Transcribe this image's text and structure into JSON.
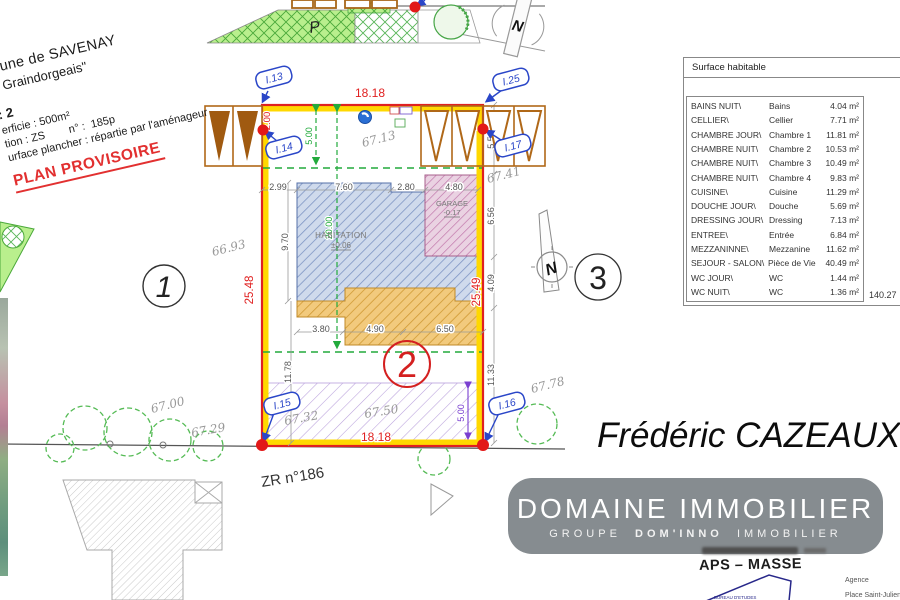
{
  "site_header": {
    "line1": "mune de SAVENAY",
    "line2": "a Graindorgeais\"",
    "line3": ": 2",
    "line4": "erficie : 500m²",
    "line5": "tion : ZS        n° :  185p",
    "line6": "urface plancher : répartie par l'aménageur",
    "stamp": "PLAN PROVISOIRE"
  },
  "plan": {
    "parcel_ref": "ZR n°186",
    "parking_label": "P",
    "north_label": "N",
    "lot_numbers": {
      "left": "1",
      "current": "2",
      "right": "3"
    },
    "point_labels": {
      "p13": "I.13",
      "p25": "I.25",
      "p14": "I.14",
      "p17": "I.17",
      "p15": "I.15",
      "p16": "I.16"
    },
    "buildings": {
      "habitation": "HABITATION",
      "habitation_level": "±0.06",
      "garage": "GARAGE",
      "garage_level": "-0.17"
    },
    "dims_red": {
      "width_top": "18.18",
      "width_bottom": "18.18",
      "depth_left": "25.48",
      "depth_right": "25.49",
      "corner_left": "2.00",
      "corner_right": "2.00"
    },
    "dims_green": {
      "front_setback": "5.00",
      "build_depth": "20.00"
    },
    "dims_purple": {
      "rear_strip": "5.00"
    },
    "dims_gray": {
      "front_row": [
        "2.99",
        "7.60",
        "2.80",
        "4.80"
      ],
      "rear_row": [
        "3.80",
        "4.90",
        "6.50"
      ],
      "house_left": "9.70",
      "rear_left": "11.78",
      "rear_right": "11.33",
      "right_upper": "5.50",
      "right_mid": "6.56",
      "right_lower": "4.09"
    },
    "elevations": [
      "67.13",
      "66.93",
      "67.00",
      "67.29",
      "67.41",
      "67.78",
      "67.50",
      "67.32"
    ]
  },
  "area_table": {
    "title": "Surface habitable",
    "rows": [
      {
        "code": "BAINS NUIT\\",
        "name": "Bains",
        "area": "4.04 m²"
      },
      {
        "code": "CELLIER\\",
        "name": "Cellier",
        "area": "7.71 m²"
      },
      {
        "code": "CHAMBRE JOUR\\",
        "name": "Chambre 1",
        "area": "11.81 m²"
      },
      {
        "code": "CHAMBRE NUIT\\",
        "name": "Chambre 2",
        "area": "10.53 m²"
      },
      {
        "code": "CHAMBRE NUIT\\",
        "name": "Chambre 3",
        "area": "10.49 m²"
      },
      {
        "code": "CHAMBRE NUIT\\",
        "name": "Chambre 4",
        "area": "9.83 m²"
      },
      {
        "code": "CUISINE\\",
        "name": "Cuisine",
        "area": "11.29 m²"
      },
      {
        "code": "DOUCHE JOUR\\",
        "name": "Douche",
        "area": "5.69 m²"
      },
      {
        "code": "DRESSING JOUR\\",
        "name": "Dressing",
        "area": "7.13 m²"
      },
      {
        "code": "ENTREE\\",
        "name": "Entrée",
        "area": "6.84 m²"
      },
      {
        "code": "MEZZANINNE\\",
        "name": "Mezzanine",
        "area": "11.62 m²"
      },
      {
        "code": "SEJOUR - SALON\\",
        "name": "Pièce de Vie",
        "area": "40.49 m²"
      },
      {
        "code": "WC JOUR\\",
        "name": "WC",
        "area": "1.44 m²"
      },
      {
        "code": "WC NUIT\\",
        "name": "WC",
        "area": "1.36 m²"
      }
    ],
    "total": "140.27"
  },
  "signature": "Frédéric CAZEAUX",
  "brand": {
    "name": "DOMAINE IMMOBILIER",
    "sub_group": "GROUPE",
    "sub_name": "DOM'INNO",
    "sub_suffix": "IMMOBILIER"
  },
  "footer": {
    "company": "APS – MASSE",
    "logo_text": "BUREAU D'ETUDES",
    "agency_label": "Agence",
    "address": "Place Saint-Julien 58"
  },
  "colors": {
    "boundary_red": "#e02020",
    "boundary_yellow": "#ffd800",
    "dashed_green": "#22aa3c",
    "point_blue": "#2a46c8",
    "lot_red": "#d42020",
    "stamp_red": "#e23030",
    "banner_gray": "#868c90"
  }
}
